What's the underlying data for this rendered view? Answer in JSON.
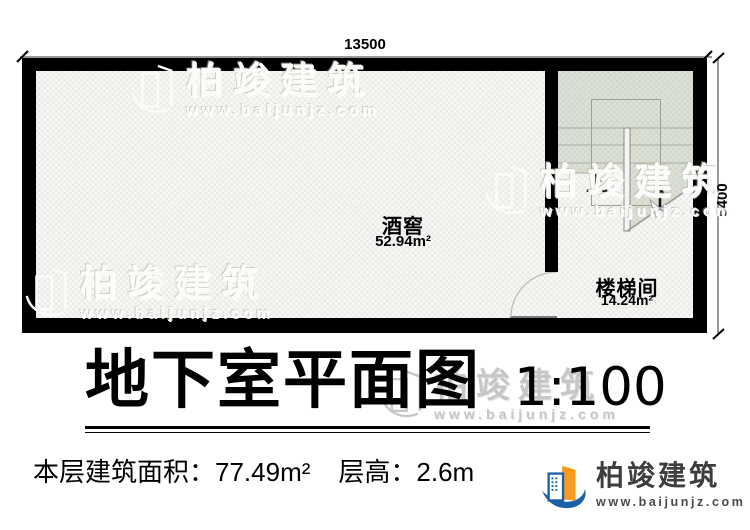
{
  "plan": {
    "dimensions": {
      "top": "13500",
      "right": "5400"
    },
    "rooms": [
      {
        "name": "酒窖",
        "area": "52.94m²"
      },
      {
        "name": "楼梯间",
        "area": "14.24m²"
      }
    ],
    "stairs": {
      "up_label": "上"
    }
  },
  "title": {
    "text": "地下室平面图",
    "scale": "1:100"
  },
  "info": {
    "building_area": "本层建筑面积：77.49m²",
    "floor_height": "层高：2.6m"
  },
  "brand": {
    "name": "柏竣建筑",
    "url": "www.baijunjz.com"
  },
  "watermark": {
    "name": "柏竣建筑",
    "url": "www.baijunjz.com"
  },
  "colors": {
    "wall": "#000000",
    "stair_tint": "#dce0d5",
    "brand_blue": "#1b5fa7",
    "brand_orange": "#f59b20"
  }
}
